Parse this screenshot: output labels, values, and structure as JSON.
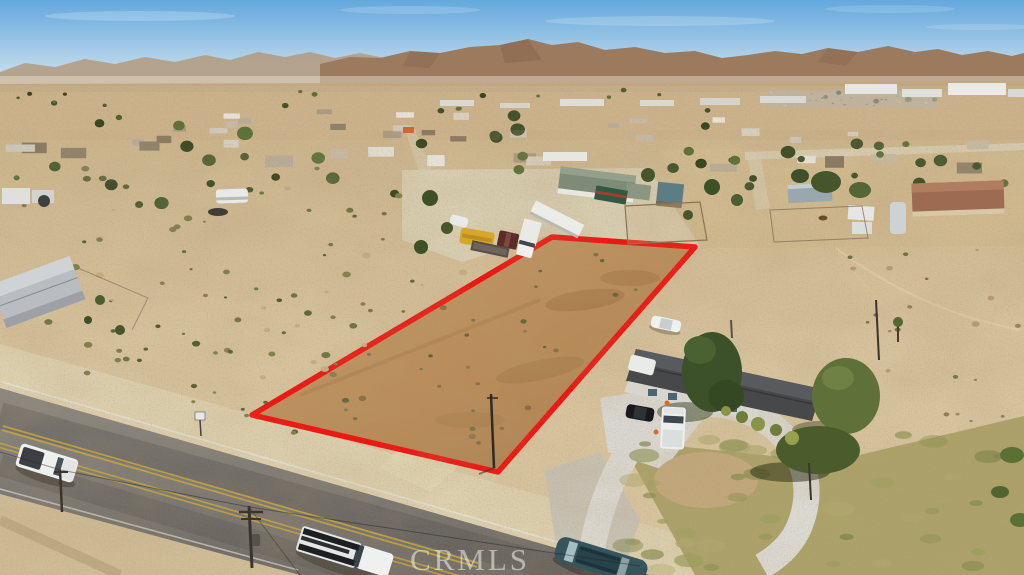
{
  "watermark": {
    "text": "CRMLS"
  },
  "scene": {
    "kind": "aerial drone photograph",
    "subject": "vacant desert land parcel outlined in red",
    "surroundings": [
      "high-desert town sprawl",
      "brown mountain range on horizon",
      "paved two-lane road in foreground with traffic",
      "single-story home with dark roof and circular concrete driveway",
      "truck yard with yellow school bus and white trailers"
    ],
    "vehicles_visible": [
      "white pickup truck on road",
      "white utility truck with ladder rack",
      "dark teal SUV",
      "white sedan",
      "black car in driveway",
      "white pickup in driveway",
      "yellow school bus",
      "white box truck",
      "white semi trailer",
      "green trailer"
    ]
  },
  "palette": {
    "boundary_red": "#ee1410",
    "sky_top": "#63a8dd",
    "sky_horizon": "#dde9ee",
    "mountain_brown": "#9b7a5e",
    "desert_tan": "#d6c29c",
    "parcel_dirt": "#bb8f60",
    "road_asphalt": "#7d7973",
    "concrete_gray": "#d9d7d0",
    "tree_green": "#45552e",
    "roof_charcoal": "#46484a",
    "watermark_white": "rgba(255,255,255,0.5)"
  }
}
